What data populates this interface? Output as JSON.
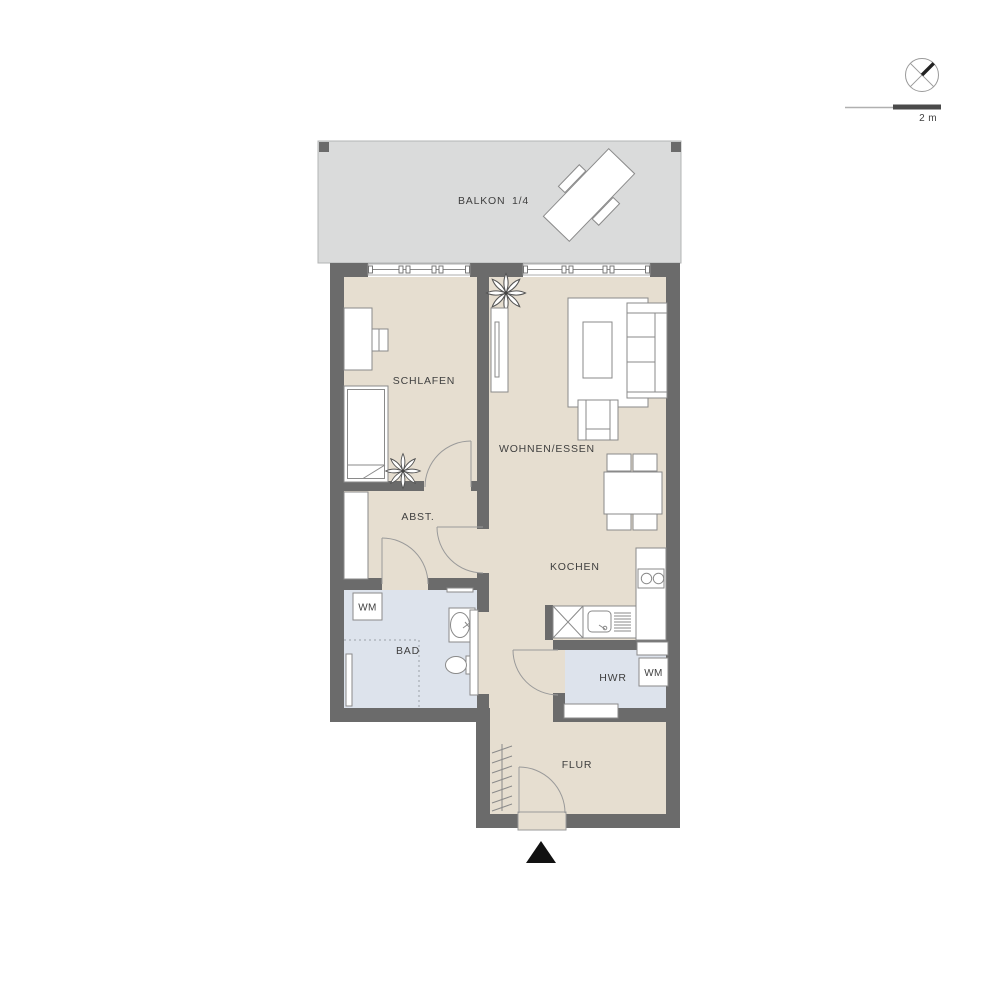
{
  "plan_title": "apartment floor plan",
  "rooms": {
    "balkon": {
      "label": "BALKON",
      "fraction": "1/4"
    },
    "schlafen": {
      "label": "SCHLAFEN"
    },
    "wohnen": {
      "label": "WOHNEN/ESSEN"
    },
    "abst": {
      "label": "ABST."
    },
    "bad": {
      "label": "BAD",
      "wm_label": "WM"
    },
    "kochen": {
      "label": "KOCHEN"
    },
    "hwr": {
      "label": "HWR",
      "wm_label": "WM"
    },
    "flur": {
      "label": "FLUR"
    }
  },
  "scale_bar": {
    "label": "2 m"
  },
  "colors": {
    "wall": "#6b6b6b",
    "floor": "#e6ded0",
    "wet_room": "#dde3ec",
    "balcony": "#dadbdb",
    "furniture_outline": "#8a8a8a",
    "entrance_marker": "#111111"
  }
}
